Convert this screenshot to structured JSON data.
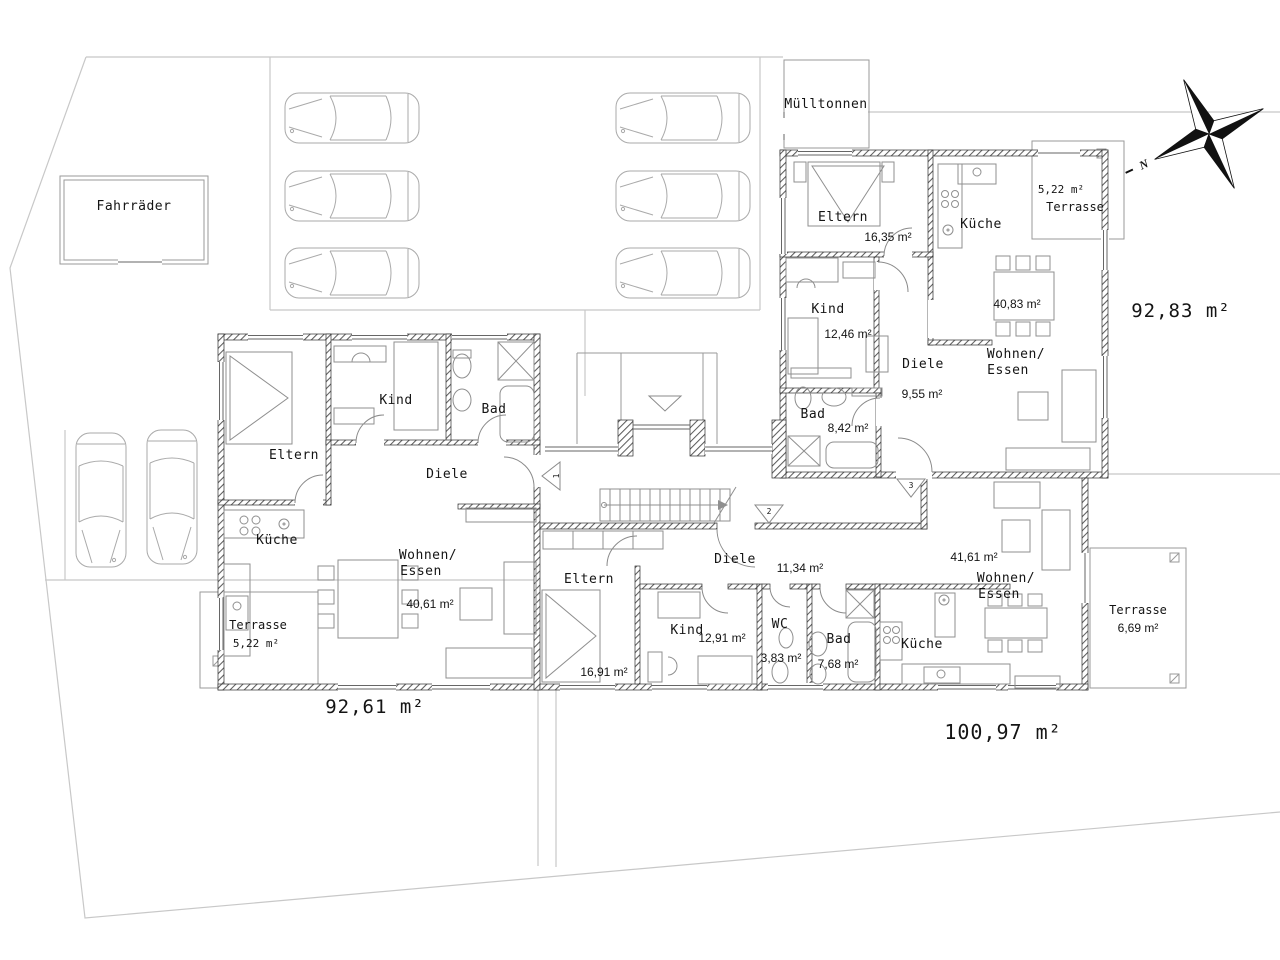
{
  "site": {
    "bike_storage_label": "Fahrräder",
    "waste_bins_label": "Mülltonnen",
    "compass_north_label": "N"
  },
  "apartment_left": {
    "total_area": "92,61 m²",
    "entrance_number": "1",
    "rooms": {
      "eltern": "Eltern",
      "kind": "Kind",
      "bad": "Bad",
      "diele": "Diele",
      "kueche": "Küche",
      "wohnen_line1": "Wohnen/",
      "wohnen_line2": "Essen",
      "wohnen_area": "40,61 m²",
      "terrasse": "Terrasse",
      "terrasse_area": "5,22 m²"
    }
  },
  "apartment_top_right": {
    "total_area": "92,83 m²",
    "entrance_number": "3",
    "rooms": {
      "eltern": "Eltern",
      "eltern_area": "16,35 m²",
      "kind": "Kind",
      "kind_area": "12,46 m²",
      "kueche": "Küche",
      "diele": "Diele",
      "diele_area": "9,55 m²",
      "bad": "Bad",
      "bad_area": "8,42 m²",
      "wohnen_line1": "Wohnen/",
      "wohnen_line2": "Essen",
      "wohnen_area": "40,83 m²",
      "terrasse": "Terrasse",
      "terrasse_area": "5,22 m²"
    }
  },
  "apartment_bottom": {
    "total_area": "100,97 m²",
    "entrance_number": "2",
    "rooms": {
      "eltern": "Eltern",
      "eltern_area": "16,91 m²",
      "kind": "Kind",
      "kind_area": "12,91 m²",
      "wc": "WC",
      "wc_area": "3,83 m²",
      "bad": "Bad",
      "bad_area": "7,68 m²",
      "kueche": "Küche",
      "diele": "Diele",
      "diele_area": "11,34 m²",
      "wohnen_line1": "Wohnen/",
      "wohnen_line2": "Essen",
      "wohnen_area": "41,61 m²",
      "terrasse": "Terrasse",
      "terrasse_area": "6,69 m²"
    }
  },
  "colors": {
    "walls": "#2f2f2f",
    "furniture_lines": "#8f8f8f",
    "site_lines": "#c8c8c8",
    "text": "#141414",
    "background": "#ffffff"
  }
}
